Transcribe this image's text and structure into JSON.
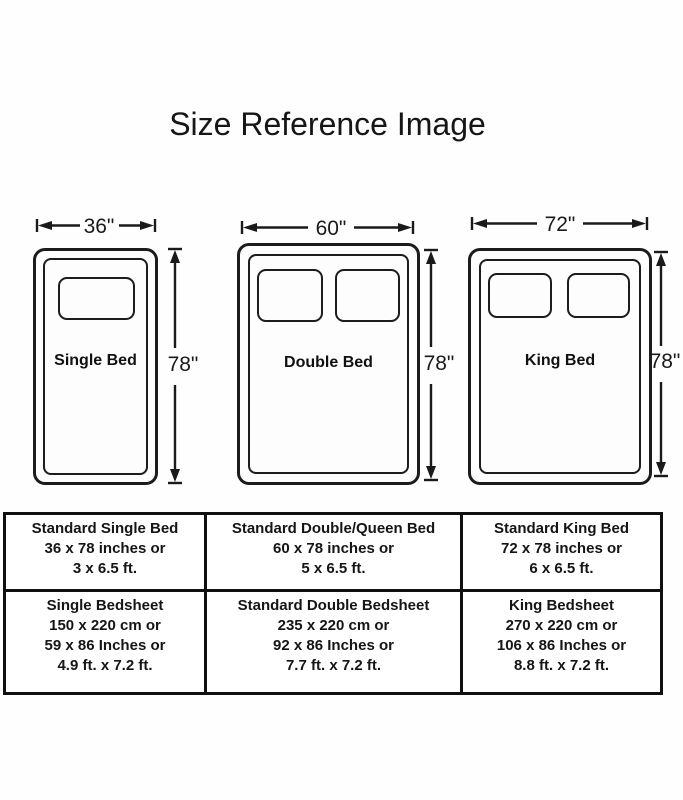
{
  "title": "Size Reference Image",
  "colors": {
    "ink": "#1a1a1a",
    "background": "#ffffff"
  },
  "beds": [
    {
      "name": "Single Bed",
      "width": "36\"",
      "height": "78\"",
      "pillow_count": 1
    },
    {
      "name": "Double Bed",
      "width": "60\"",
      "height": "78\"",
      "pillow_count": 2
    },
    {
      "name": "King Bed",
      "width": "72\"",
      "height": "78\"",
      "pillow_count": 2
    }
  ],
  "table": {
    "bed_row": [
      {
        "lines": [
          "Standard Single Bed",
          "36 x 78 inches or",
          "3 x 6.5 ft."
        ]
      },
      {
        "lines": [
          "Standard Double/Queen Bed",
          "60 x 78 inches or",
          "5 x 6.5 ft."
        ]
      },
      {
        "lines": [
          "Standard King Bed",
          "72 x 78 inches or",
          "6 x 6.5 ft."
        ]
      }
    ],
    "sheet_row": [
      {
        "lines": [
          "Single Bedsheet",
          "150 x 220 cm or",
          "59 x 86 Inches or",
          "4.9 ft. x 7.2 ft."
        ]
      },
      {
        "lines": [
          "Standard Double Bedsheet",
          "235 x 220 cm or",
          "92 x 86 Inches or",
          "7.7 ft. x 7.2 ft."
        ]
      },
      {
        "lines": [
          "King Bedsheet",
          "270 x 220 cm or",
          "106 x 86 Inches or",
          "8.8 ft. x 7.2 ft."
        ]
      }
    ]
  }
}
